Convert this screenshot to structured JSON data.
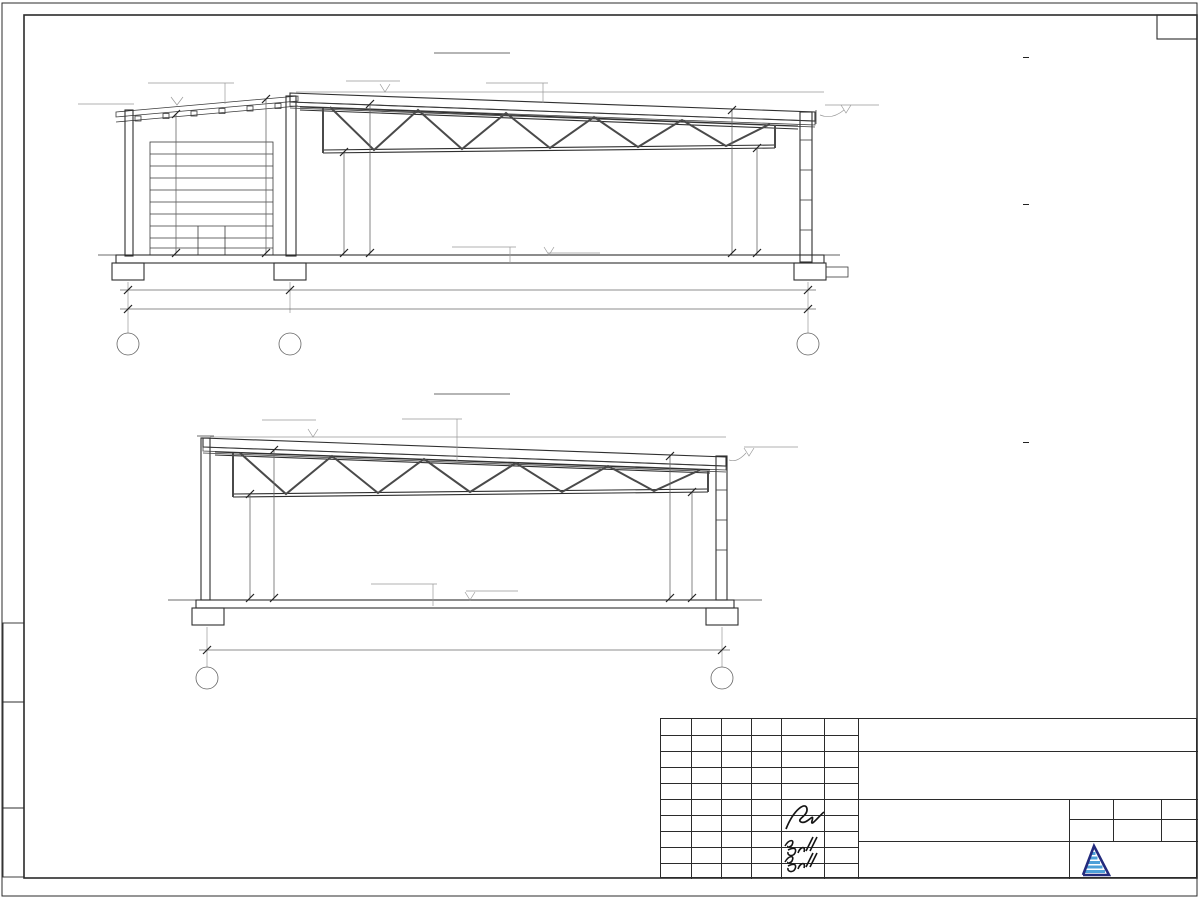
{
  "section33": {
    "title": "РАЗРЕЗ 3-3",
    "labels": {
      "sostav1": "Состав 1",
      "sostav2": "Состав 2",
      "sostav3": "Состав 3"
    },
    "elevations": {
      "annex": "+4.990",
      "ridge": "+5.770",
      "right": "+5.005",
      "floor": "0.000"
    },
    "dims": {
      "annex_left": "4757",
      "annex_right": "5195",
      "hall_left_low": "3563",
      "hall_left_high": "4990",
      "hall_right_high": "4693",
      "hall_right_low": "3300",
      "bottom_left": "5150",
      "bottom_right": "17000",
      "bottom_total": "22150"
    },
    "grids": [
      "Ж",
      "Е",
      "А"
    ]
  },
  "section44": {
    "title": "РАЗРЕЗ 4-4",
    "labels": {
      "sostav1": "Состав 1",
      "sostav2": "Состав 2"
    },
    "elevations": {
      "ridge": "+5.770",
      "right": "+5.005",
      "floor": "0.000"
    },
    "dims": {
      "left_low": "3563",
      "left_high": "4990",
      "right_high": "4593",
      "right_low": "3300",
      "bottom": "17000"
    },
    "grids": [
      "Е",
      "А"
    ]
  },
  "compositions": [
    {
      "title": "Состав 1",
      "rows": [
        {
          "t": "Топпинг Refloor"
        },
        {
          "t": "Железобетонная  монолитная плита"
        },
        {
          "t": "из бетона В 22,5 (М300)",
          "v": "– 200 мм",
          "c": true
        },
        {
          "t": "Сетка из арматурных стержней"
        },
        {
          "t": "Пленка полиэтиленовая",
          "v": "– 2 слоя"
        },
        {
          "t": "Подготовка из песка средней крупности",
          "v": "– 350 мм"
        },
        {
          "t": "Грунт основания"
        }
      ]
    },
    {
      "title": "Состав 2",
      "rows": [
        {
          "t": "Мембрана ПВХ",
          "v": "– 1 слой"
        },
        {
          "t": "Геотекстиль",
          "v": "– 1 слой"
        },
        {
          "t": "Утеплитель ПЕНОПЛЭКС,"
        },
        {
          "t": "толщиной 50 мм",
          "v": "– 3 слоя",
          "c": true
        },
        {
          "t": "Утеплитель Эковер Y=100 кг/м3,"
        },
        {
          "t": "толщиной 50 мм",
          "v": "– 1 слой",
          "c": true
        },
        {
          "t": "Пароизоляция для плоских кровель",
          "v": "– 1 слой"
        },
        {
          "t": "Профнастил Н 114х0.9 мм"
        },
        {
          "t": "Металлическая ферма"
        },
        {
          "t": "(с торца металлическая балка)",
          "c": true
        }
      ]
    },
    {
      "title": "Состав 3",
      "rows": [
        {
          "t": "Сэндвич-панель 50 мм."
        },
        {
          "t": "Прогоны, профтруба"
        },
        {
          "t": "Металлическая балка"
        }
      ]
    }
  ],
  "notes": [
    "1. Разрез 3-3 замаркирован см. л. АР-15.",
    "2. Разрез 4-4 замаркирован см. л. АР-15."
  ],
  "titleblock": {
    "headers": [
      "Изм.",
      "Кол.",
      "Лист",
      "№док.",
      "Подп.",
      "Дата"
    ],
    "rows": [
      {
        "role": "Разработал",
        "name": "Решетова",
        "date": "04.24"
      },
      {
        "role": "Н. контр.",
        "name": "Завьялова",
        "date": "04.24"
      },
      {
        "role": "ГИП",
        "name": "Завьялова",
        "date": "04.24"
      }
    ],
    "sheet_name": [
      "Разрез 3-3",
      "Разрез 4-4"
    ],
    "stage_label": "Стадия",
    "sheet_label": "Лист",
    "sheets_label": "Листов",
    "stage": "ЭП",
    "sheet": "18",
    "sheets": "19",
    "logo": {
      "name": "АЛЬЯНС",
      "subtitle": "строительная компания",
      "color": "#232b7e",
      "accent": "#4da0d8"
    }
  }
}
